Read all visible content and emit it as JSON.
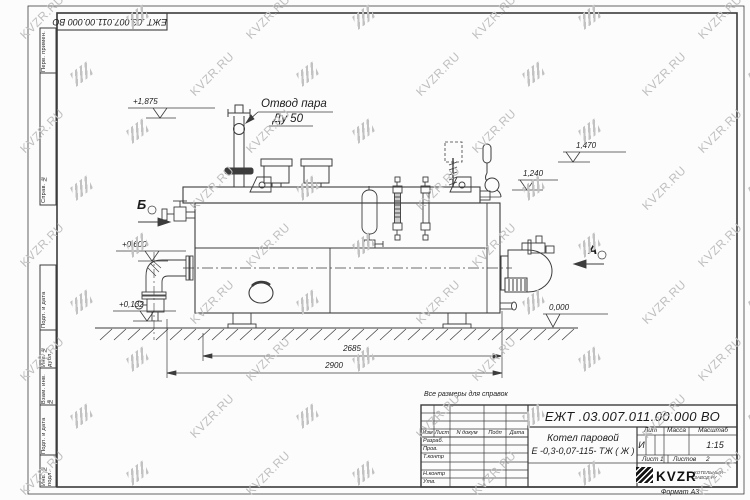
{
  "sheet": {
    "note_reference": "Все размеры для справок",
    "format_label": "Формат А3",
    "stamp_rotated": "ЕЖТ .03.007.011.00.000  ВО"
  },
  "watermark": {
    "text": "KVZR.RU"
  },
  "margin_fields": [
    {
      "label": "Перв. примен."
    },
    {
      "label": "Справ. №"
    },
    {
      "label": "Подп. и дата"
    },
    {
      "label": "Инв. № дубл."
    },
    {
      "label": "Взам. инв. №"
    },
    {
      "label": "Подп. и дата"
    },
    {
      "label": "Инв. № подл."
    }
  ],
  "annotations": {
    "steam_outlet": {
      "line1": "Отвод пара",
      "line2": "Ду 50"
    },
    "view_b": "Б",
    "view_a": "А",
    "levels": {
      "l1875": "+1,875",
      "l1470": "1,470",
      "l1240": "1,240",
      "l0600": "+0,600",
      "l0132": "+0,132",
      "l0000": "0,000"
    },
    "dimensions": {
      "inner": "2685",
      "outer": "2900"
    }
  },
  "title_block": {
    "doc_number": "ЕЖТ .03.007.011.00.000  ВО",
    "product": {
      "line1": "Котел паровой",
      "line2": "Е -0,3-0,07-115- ТЖ ( Ж )"
    },
    "header_cols": {
      "izm": "Изм",
      "list": "Лист",
      "ndoc": "N докум",
      "podp": "Подп",
      "data": "Дата"
    },
    "sign_rows": {
      "r1": "Разраб.",
      "r2": "Пров.",
      "r3": "Т.контр",
      "r4": "Н.контр",
      "r5": "Утв."
    },
    "lit": {
      "label": "Лит",
      "value": "И"
    },
    "mass": {
      "label": "Масса"
    },
    "scale": {
      "label": "Масштаб",
      "value": "1:15"
    },
    "sheet_info": {
      "list_label": "Лист",
      "list_value": "1",
      "listov_label": "Листов",
      "listov_value": "2"
    },
    "company": {
      "name": "KVZR",
      "sub1": "КОТЕЛЬНЫЙ",
      "sub2": "ЗАВОД.РУ"
    }
  }
}
